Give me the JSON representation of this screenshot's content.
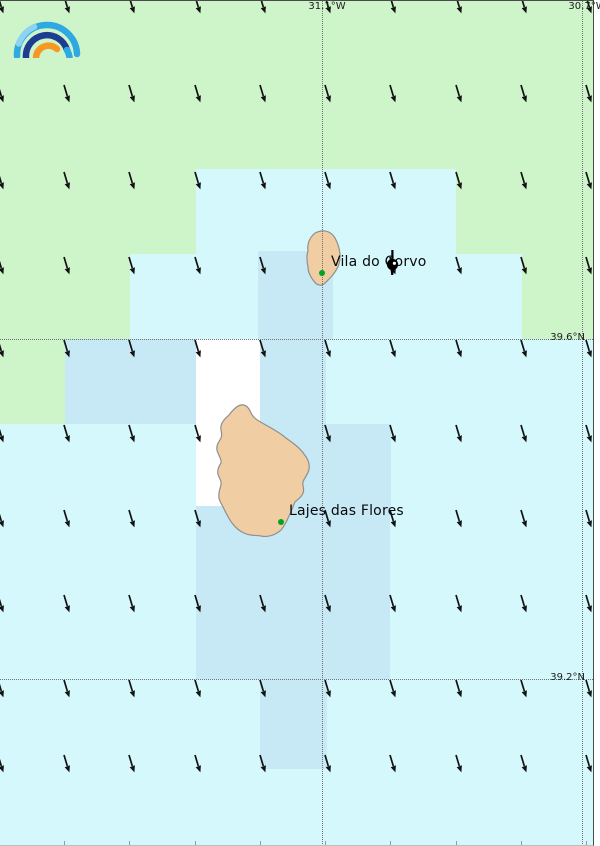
{
  "colors": {
    "land_green": "#cef4ca",
    "sea_light": "#d5f8fd",
    "sea_medium": "#c7e9f6",
    "sea_white": "#ffffff",
    "island_fill": "#f0cda3",
    "island_stroke": "#8f8f8f",
    "arrow": "#121212",
    "marker_green": "#00a41e",
    "gridline": "#707070",
    "logo_blue": "#2fa9e1",
    "logo_blue_light": "#8fd3f3",
    "logo_navy": "#1d3e90",
    "logo_orange": "#f79822"
  },
  "places": [
    {
      "label": "Vila do Corvo",
      "x": 331,
      "y": 253,
      "dot_x": 322,
      "dot_y": 272
    },
    {
      "label": "Lajes das Flores",
      "x": 289,
      "y": 502,
      "dot_x": 281,
      "dot_y": 521
    }
  ],
  "graticule": [
    {
      "label": "31.1°W",
      "axis": "x",
      "px": 322
    },
    {
      "label": "30.7°W",
      "axis": "x",
      "px": 582
    },
    {
      "label": "39.6°N",
      "axis": "y",
      "px": 338
    },
    {
      "label": "39.2°N",
      "axis": "y",
      "px": 678
    }
  ],
  "regions": {
    "land_green": [
      [
        0,
        0,
        593,
        168
      ],
      [
        0,
        168,
        196,
        85
      ],
      [
        0,
        253,
        130,
        85
      ],
      [
        0,
        338,
        65,
        85
      ],
      [
        456,
        168,
        137,
        85
      ],
      [
        522,
        253,
        71,
        85
      ]
    ],
    "sea_medium": [
      [
        258,
        250,
        75,
        88
      ],
      [
        65,
        338,
        131,
        85
      ],
      [
        260,
        338,
        66,
        85
      ],
      [
        260,
        423,
        131,
        82
      ],
      [
        196,
        505,
        194,
        173
      ],
      [
        260,
        678,
        67,
        90
      ]
    ],
    "sea_white": [
      [
        196,
        338,
        64,
        167
      ]
    ]
  },
  "wind": {
    "cols": [
      -2,
      64,
      129,
      195,
      260,
      325,
      390,
      456,
      521,
      586
    ],
    "rows": [
      -6,
      83,
      170,
      255,
      338,
      423,
      508,
      593,
      678,
      753
    ],
    "tip_dx": 5,
    "tip_dy": 16
  }
}
